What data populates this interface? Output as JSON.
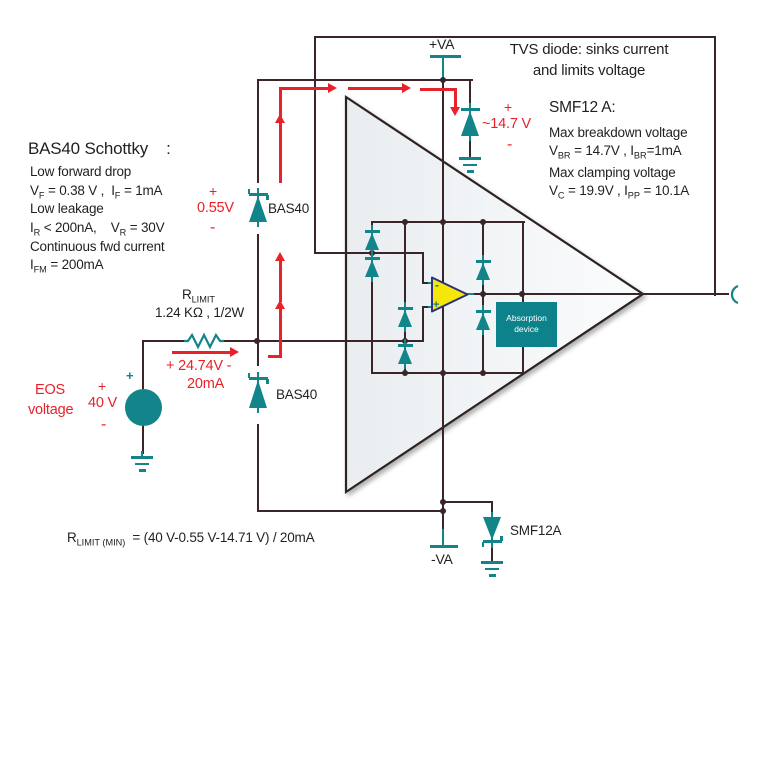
{
  "colors": {
    "teal": "#12858b",
    "wire": "#3a2629",
    "red": "#e8222b",
    "yellow": "#f6e70a",
    "opamp_border": "#2d2f7f",
    "text": "#231f20"
  },
  "bas40_note": {
    "title": "BAS40 Schottky    :",
    "l1": "Low forward drop",
    "l2": [
      "V",
      "F",
      " = 0.38 V ,  I",
      "F",
      " = 1mA"
    ],
    "l3": "Low leakage",
    "l4": [
      "I",
      "R",
      " < 200nA,    V",
      "R",
      " = 30V"
    ],
    "l5": "Continuous fwd current",
    "l6": [
      "I",
      "FM",
      " = 200mA"
    ]
  },
  "tvs_note": {
    "l1": "TVS diode: sinks current",
    "l2": "and limits voltage"
  },
  "smf_note": {
    "title": "SMF12 A:",
    "l1": "Max breakdown voltage",
    "l2": [
      "V",
      "BR",
      " = 14.7V , I",
      "BR",
      "=1mA"
    ],
    "l3": "Max clamping voltage",
    "l4": [
      "V",
      "C",
      " = 19.9V , I",
      "PP",
      " = 10.1A"
    ]
  },
  "rails": {
    "va_plus": "+VA",
    "va_minus": "-VA"
  },
  "tvs_clamp": {
    "plus": "+",
    "value": "~14.7 V",
    "minus": "-"
  },
  "bas40_top": {
    "plus": "+",
    "value": "0.55V",
    "minus": "-",
    "label": "BAS40"
  },
  "bas40_bottom": {
    "label": "BAS40"
  },
  "rlimit": {
    "name": [
      "R",
      "LIMIT"
    ],
    "value": "1.24 KΩ , 1/2W"
  },
  "current": {
    "value": "+ 24.74V -",
    "amps": "20mA"
  },
  "eos": {
    "line1": "EOS",
    "line2": "voltage",
    "plus": "+",
    "value": "40 V",
    "minus": "-",
    "source_plus": "+"
  },
  "smf12a": {
    "label": "SMF12A"
  },
  "formula": {
    "parts": [
      "R",
      "LIMIT (MIN)",
      "  = (40 V-0.55 V-14.71 V) / 20mA"
    ]
  },
  "absorption": {
    "l1": "Absorption",
    "l2": "device"
  },
  "opamp": {
    "minus": "-",
    "plus": "+"
  }
}
